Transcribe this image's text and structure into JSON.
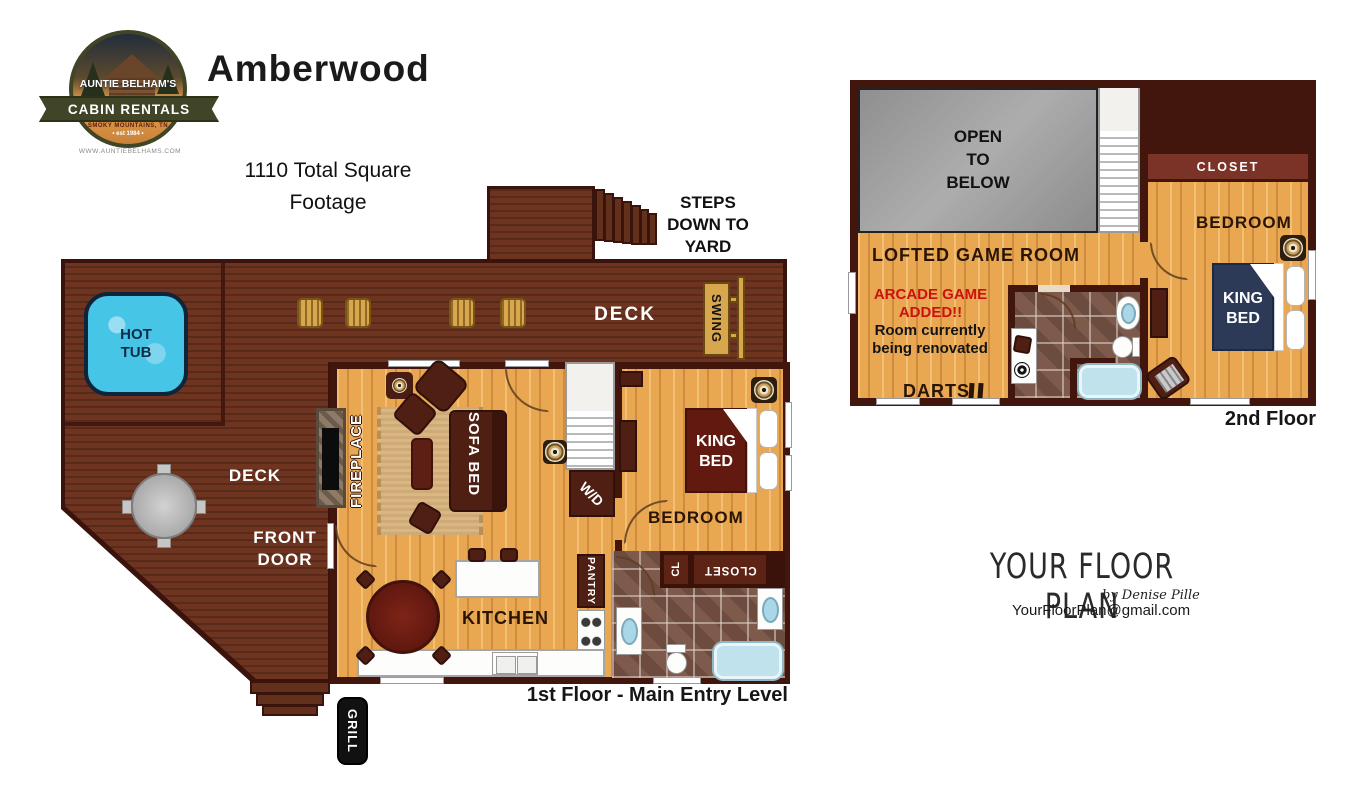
{
  "branding": {
    "logo_arc_top": "AUNTIE BELHAM'S",
    "logo_banner": "CABIN RENTALS",
    "logo_region": "SMOKY MOUNTAINS, TN",
    "logo_est": "• est 1984 •",
    "logo_url": "WWW.AUNTIEBELHAMS.COM",
    "title": "Amberwood",
    "square_footage": "1110 Total Square\nFootage"
  },
  "floor1": {
    "caption": "1st Floor - Main Entry Level",
    "deck_upper_label": "DECK",
    "deck_left_label": "DECK",
    "hot_tub_label": "HOT\nTUB",
    "swing_label": "SWING",
    "steps_label": "STEPS\nDOWN TO\nYARD",
    "front_door_label": "FRONT\nDOOR",
    "grill_label": "GRILL",
    "fireplace_label": "FIREPLACE",
    "sofa_bed_label": "SOFA BED",
    "wd_label": "W/D",
    "king_bed_label": "KING\nBED",
    "bedroom_label": "BEDROOM",
    "cl_label": "CL",
    "closet_label": "CLOSET",
    "kitchen_label": "KITCHEN",
    "pantry_label": "PANTRY"
  },
  "floor2": {
    "caption": "2nd Floor",
    "open_to_below_label": "OPEN\nTO\nBELOW",
    "game_room_label": "LOFTED GAME ROOM",
    "arcade_note": "ARCADE GAME\nADDED!!",
    "renovation_note": "Room currently\nbeing renovated",
    "darts_label": "DARTS",
    "closet_label": "CLOSET",
    "bedroom_label": "BEDROOM",
    "king_bed_label": "KING\nBED"
  },
  "credit": {
    "brand": "YOUR FLOOR PLAN",
    "byline": "by Denise Pille",
    "email": "YourFloorPlan@gmail.com"
  },
  "colors": {
    "deck": "#6e3420",
    "wall": "#43160d",
    "wood_floor": "#e9a751",
    "hot_tub": "#47c5e6",
    "bed_maroon": "#621a10",
    "bed_navy": "#2c3a58",
    "note_red": "#cc1111",
    "open_gray": "#9b9b9b",
    "gold": "#d8a64c"
  }
}
